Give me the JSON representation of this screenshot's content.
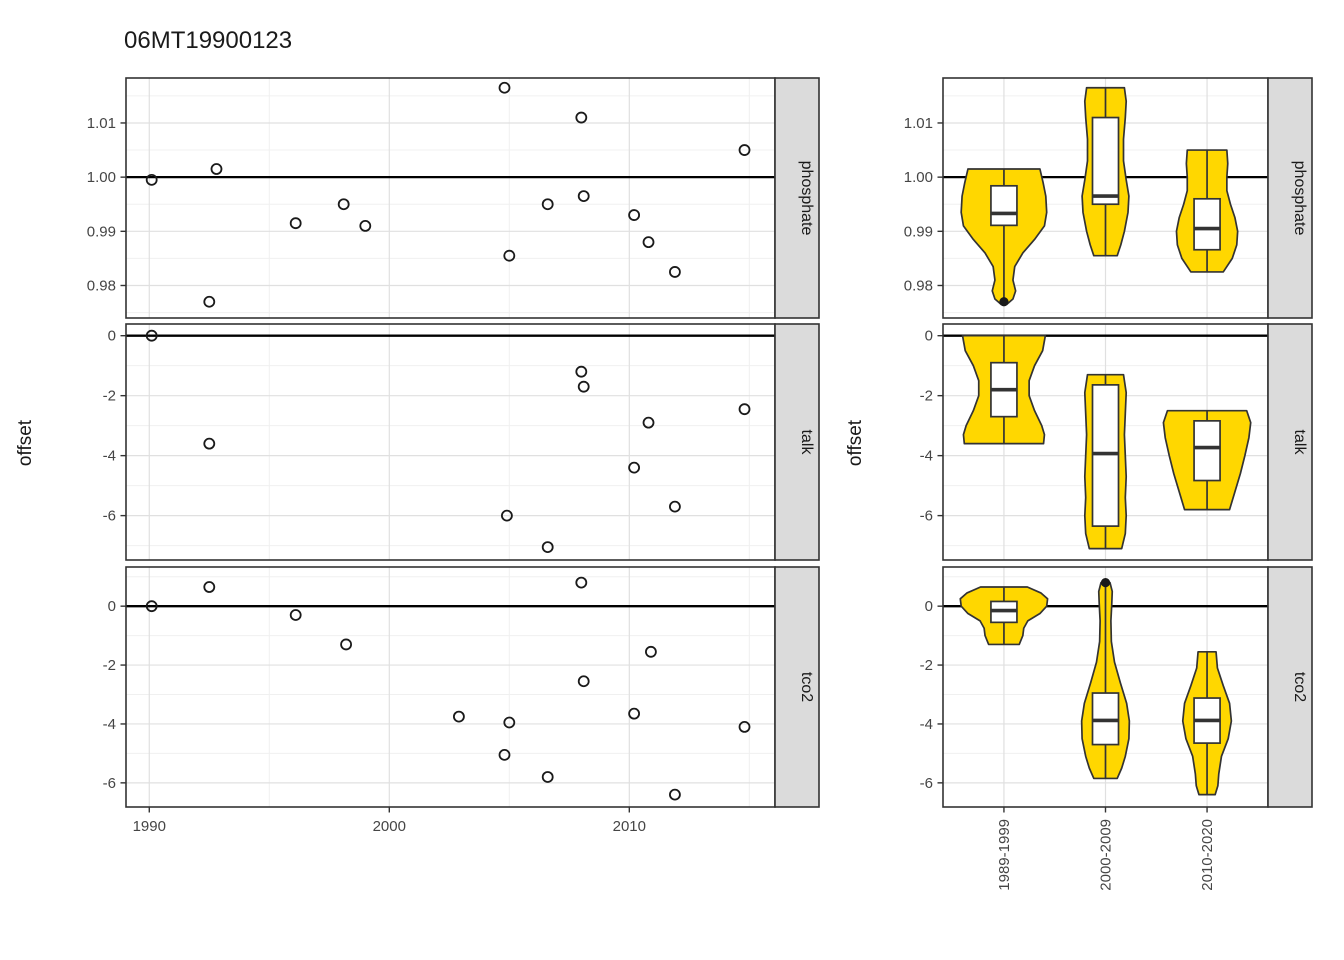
{
  "title": "06MT19900123",
  "facets": [
    "phosphate",
    "talk",
    "tco2"
  ],
  "colors": {
    "violin_fill": "#FFD700",
    "strip_bg": "#DBDBDB",
    "strip_text": "#1a1a1a",
    "panel_border": "#333333",
    "grid_major": "#E0E0E0",
    "grid_minor": "#F0F0F0",
    "axis_text": "#454545",
    "tick_mark": "#333333",
    "point_stroke": "#1a1a1a",
    "ref_line": "#000000"
  },
  "chart_data": [
    {
      "id": "left",
      "type": "scatter",
      "title": "06MT19900123",
      "xlabel": "",
      "ylabel": "offset",
      "x_ticks": [
        1990,
        2000,
        2010
      ],
      "x_tick_labels": [
        "1990",
        "2000",
        "2010"
      ],
      "x_minor": [
        1995,
        2005,
        2015
      ],
      "x_domain": [
        1989.03,
        2016.07
      ],
      "grid": true,
      "panels": [
        {
          "facet": "phosphate",
          "ref_line": 1.0,
          "y_domain": [
            0.974,
            1.0183
          ],
          "y_ticks": [
            0.98,
            0.99,
            1.0,
            1.01
          ],
          "y_tick_labels": [
            "0.98",
            "0.99",
            "1.00",
            "1.01"
          ],
          "y_minor": [
            0.975,
            0.985,
            0.995,
            1.005,
            1.015
          ],
          "points": [
            [
              1990.1,
              0.9995
            ],
            [
              1992.5,
              0.977
            ],
            [
              1992.8,
              1.0015
            ],
            [
              1996.1,
              0.9915
            ],
            [
              1998.1,
              0.995
            ],
            [
              1999.0,
              0.991
            ],
            [
              2004.8,
              1.0165
            ],
            [
              2005.0,
              0.9855
            ],
            [
              2006.6,
              0.995
            ],
            [
              2008.0,
              1.011
            ],
            [
              2008.1,
              0.9965
            ],
            [
              2010.2,
              0.993
            ],
            [
              2010.8,
              0.988
            ],
            [
              2011.9,
              0.9825
            ],
            [
              2014.8,
              1.005
            ]
          ]
        },
        {
          "facet": "talk",
          "ref_line": 0,
          "y_domain": [
            -7.48,
            0.39
          ],
          "y_ticks": [
            0,
            -2,
            -4,
            -6
          ],
          "y_tick_labels": [
            "0",
            "-2",
            "-4",
            "-6"
          ],
          "y_minor": [
            -1,
            -3,
            -5,
            -7
          ],
          "points": [
            [
              1990.1,
              0.0
            ],
            [
              1992.5,
              -3.6
            ],
            [
              2004.9,
              -6.0
            ],
            [
              2006.6,
              -7.05
            ],
            [
              2008.0,
              -1.2
            ],
            [
              2008.1,
              -1.7
            ],
            [
              2010.2,
              -4.4
            ],
            [
              2010.8,
              -2.9
            ],
            [
              2011.9,
              -5.7
            ],
            [
              2014.8,
              -2.45
            ]
          ]
        },
        {
          "facet": "tco2",
          "ref_line": 0,
          "y_domain": [
            -6.82,
            1.33
          ],
          "y_ticks": [
            0,
            -2,
            -4,
            -6
          ],
          "y_tick_labels": [
            "0",
            "-2",
            "-4",
            "-6"
          ],
          "y_minor": [
            1,
            -1,
            -3,
            -5
          ],
          "points": [
            [
              1990.1,
              0.0
            ],
            [
              1992.5,
              0.65
            ],
            [
              1996.1,
              -0.3
            ],
            [
              1998.2,
              -1.3
            ],
            [
              2002.9,
              -3.75
            ],
            [
              2004.8,
              -5.05
            ],
            [
              2005.0,
              -3.95
            ],
            [
              2006.6,
              -5.8
            ],
            [
              2008.0,
              0.8
            ],
            [
              2008.1,
              -2.55
            ],
            [
              2010.2,
              -3.65
            ],
            [
              2010.9,
              -1.55
            ],
            [
              2011.9,
              -6.4
            ],
            [
              2014.8,
              -4.1
            ]
          ]
        }
      ]
    },
    {
      "id": "right",
      "type": "violin",
      "xlabel": "",
      "ylabel": "offset",
      "categories": [
        "1989-1999",
        "2000-2009",
        "2010-2020"
      ],
      "grid": true,
      "panels": [
        {
          "facet": "phosphate",
          "ref_line": 1.0,
          "y_domain": [
            0.974,
            1.0183
          ],
          "y_ticks": [
            0.98,
            0.99,
            1.0,
            1.01
          ],
          "y_tick_labels": [
            "0.98",
            "0.99",
            "1.00",
            "1.01"
          ],
          "y_minor": [
            0.975,
            0.985,
            0.995,
            1.005,
            1.015
          ],
          "violins": [
            {
              "category": "1989-1999",
              "profile": [
                [
                  1.0015,
                  0.8
                ],
                [
                  0.999,
                  0.87
                ],
                [
                  0.9965,
                  0.93
                ],
                [
                  0.9935,
                  0.95
                ],
                [
                  0.991,
                  0.9
                ],
                [
                  0.9885,
                  0.68
                ],
                [
                  0.986,
                  0.42
                ],
                [
                  0.9835,
                  0.24
                ],
                [
                  0.981,
                  0.2
                ],
                [
                  0.979,
                  0.26
                ],
                [
                  0.9775,
                  0.2
                ],
                [
                  0.9765,
                  0.06
                ]
              ],
              "box": {
                "q1": 0.9911,
                "median": 0.9933,
                "q3": 0.9984
              },
              "whiskers": [
                0.991,
                1.0015
              ],
              "outliers": [
                0.977
              ]
            },
            {
              "category": "2000-2009",
              "profile": [
                [
                  1.0165,
                  0.42
                ],
                [
                  1.014,
                  0.46
                ],
                [
                  1.011,
                  0.44
                ],
                [
                  1.007,
                  0.4
                ],
                [
                  1.003,
                  0.4
                ],
                [
                  0.9995,
                  0.46
                ],
                [
                  0.9965,
                  0.52
                ],
                [
                  0.9935,
                  0.5
                ],
                [
                  0.99,
                  0.42
                ],
                [
                  0.9875,
                  0.34
                ],
                [
                  0.9855,
                  0.26
                ]
              ],
              "box": {
                "q1": 0.995,
                "median": 0.9965,
                "q3": 1.011
              },
              "whiskers": [
                0.9855,
                1.0165
              ],
              "outliers": []
            },
            {
              "category": "2010-2020",
              "profile": [
                [
                  1.005,
                  0.44
                ],
                [
                  1.0025,
                  0.46
                ],
                [
                  1.0,
                  0.44
                ],
                [
                  0.9975,
                  0.44
                ],
                [
                  0.995,
                  0.52
                ],
                [
                  0.9925,
                  0.62
                ],
                [
                  0.99,
                  0.68
                ],
                [
                  0.9875,
                  0.66
                ],
                [
                  0.985,
                  0.56
                ],
                [
                  0.9825,
                  0.36
                ]
              ],
              "box": {
                "q1": 0.9866,
                "median": 0.9905,
                "q3": 0.996
              },
              "whiskers": [
                0.9825,
                1.005
              ],
              "outliers": []
            }
          ]
        },
        {
          "facet": "talk",
          "ref_line": 0,
          "y_domain": [
            -7.48,
            0.39
          ],
          "y_ticks": [
            0,
            -2,
            -4,
            -6
          ],
          "y_tick_labels": [
            "0",
            "-2",
            "-4",
            "-6"
          ],
          "y_minor": [
            -1,
            -3,
            -5,
            -7
          ],
          "violins": [
            {
              "category": "1989-1999",
              "profile": [
                [
                  0.0,
                  0.92
                ],
                [
                  -0.5,
                  0.86
                ],
                [
                  -1.0,
                  0.68
                ],
                [
                  -1.5,
                  0.56
                ],
                [
                  -2.0,
                  0.56
                ],
                [
                  -2.5,
                  0.68
                ],
                [
                  -3.0,
                  0.84
                ],
                [
                  -3.3,
                  0.9
                ],
                [
                  -3.6,
                  0.88
                ]
              ],
              "box": {
                "q1": -2.7,
                "median": -1.8,
                "q3": -0.9
              },
              "whiskers": [
                -3.6,
                0.0
              ],
              "outliers": []
            },
            {
              "category": "2000-2009",
              "profile": [
                [
                  -1.3,
                  0.4
                ],
                [
                  -1.9,
                  0.46
                ],
                [
                  -2.6,
                  0.44
                ],
                [
                  -3.3,
                  0.42
                ],
                [
                  -4.0,
                  0.44
                ],
                [
                  -4.7,
                  0.46
                ],
                [
                  -5.4,
                  0.44
                ],
                [
                  -6.0,
                  0.46
                ],
                [
                  -6.6,
                  0.44
                ],
                [
                  -7.1,
                  0.36
                ]
              ],
              "box": {
                "q1": -6.35,
                "median": -3.93,
                "q3": -1.64
              },
              "whiskers": [
                -7.1,
                -1.3
              ],
              "outliers": []
            },
            {
              "category": "2010-2020",
              "profile": [
                [
                  -2.5,
                  0.88
                ],
                [
                  -2.9,
                  0.97
                ],
                [
                  -3.4,
                  0.93
                ],
                [
                  -4.0,
                  0.84
                ],
                [
                  -4.6,
                  0.74
                ],
                [
                  -5.2,
                  0.62
                ],
                [
                  -5.8,
                  0.5
                ]
              ],
              "box": {
                "q1": -4.83,
                "median": -3.73,
                "q3": -2.84
              },
              "whiskers": [
                -5.8,
                -2.5
              ],
              "outliers": []
            }
          ]
        },
        {
          "facet": "tco2",
          "ref_line": 0,
          "y_domain": [
            -6.82,
            1.33
          ],
          "y_ticks": [
            0,
            -2,
            -4,
            -6
          ],
          "y_tick_labels": [
            "0",
            "-2",
            "-4",
            "-6"
          ],
          "y_minor": [
            1,
            -1,
            -3,
            -5
          ],
          "violins": [
            {
              "category": "1989-1999",
              "profile": [
                [
                  0.65,
                  0.52
                ],
                [
                  0.45,
                  0.82
                ],
                [
                  0.25,
                  0.97
                ],
                [
                  0.0,
                  0.95
                ],
                [
                  -0.25,
                  0.8
                ],
                [
                  -0.5,
                  0.53
                ],
                [
                  -0.75,
                  0.44
                ],
                [
                  -1.0,
                  0.42
                ],
                [
                  -1.3,
                  0.34
                ]
              ],
              "box": {
                "q1": -0.55,
                "median": -0.15,
                "q3": 0.16
              },
              "whiskers": [
                -1.3,
                0.65
              ],
              "outliers": []
            },
            {
              "category": "2000-2009",
              "profile": [
                [
                  0.8,
                  0.1
                ],
                [
                  0.5,
                  0.15
                ],
                [
                  0.1,
                  0.14
                ],
                [
                  -0.5,
                  0.12
                ],
                [
                  -1.2,
                  0.13
                ],
                [
                  -1.9,
                  0.2
                ],
                [
                  -2.6,
                  0.33
                ],
                [
                  -3.3,
                  0.47
                ],
                [
                  -3.9,
                  0.53
                ],
                [
                  -4.5,
                  0.52
                ],
                [
                  -5.1,
                  0.44
                ],
                [
                  -5.5,
                  0.36
                ],
                [
                  -5.85,
                  0.26
                ]
              ],
              "box": {
                "q1": -4.7,
                "median": -3.88,
                "q3": -2.95
              },
              "whiskers": [
                -5.85,
                -2.55
              ],
              "outliers": [
                0.8
              ]
            },
            {
              "category": "2010-2020",
              "profile": [
                [
                  -1.55,
                  0.2
                ],
                [
                  -2.1,
                  0.23
                ],
                [
                  -2.7,
                  0.36
                ],
                [
                  -3.3,
                  0.5
                ],
                [
                  -3.9,
                  0.54
                ],
                [
                  -4.5,
                  0.47
                ],
                [
                  -5.1,
                  0.32
                ],
                [
                  -5.7,
                  0.26
                ],
                [
                  -6.1,
                  0.24
                ],
                [
                  -6.4,
                  0.18
                ]
              ],
              "box": {
                "q1": -4.65,
                "median": -3.88,
                "q3": -3.12
              },
              "whiskers": [
                -6.4,
                -1.55
              ],
              "outliers": []
            }
          ]
        }
      ]
    }
  ]
}
